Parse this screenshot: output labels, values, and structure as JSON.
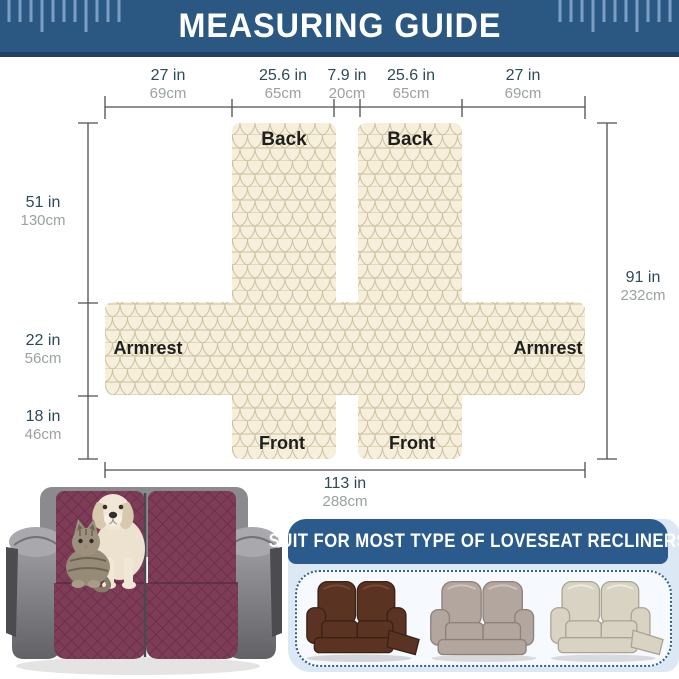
{
  "header": {
    "title": "MEASURING GUIDE"
  },
  "diagram": {
    "top_measurements": [
      {
        "in": "27 in",
        "cm": "69cm"
      },
      {
        "in": "25.6 in",
        "cm": "65cm"
      },
      {
        "in": "7.9 in",
        "cm": "20cm"
      },
      {
        "in": "25.6 in",
        "cm": "65cm"
      },
      {
        "in": "27 in",
        "cm": "69cm"
      }
    ],
    "left_measurements": [
      {
        "in": "51 in",
        "cm": "130cm"
      },
      {
        "in": "22 in",
        "cm": "56cm"
      },
      {
        "in": "18 in",
        "cm": "46cm"
      }
    ],
    "right_measurement": {
      "in": "91 in",
      "cm": "232cm"
    },
    "bottom_measurement": {
      "in": "113 in",
      "cm": "288cm"
    },
    "labels": {
      "back_left": "Back",
      "back_right": "Back",
      "armrest_left": "Armrest",
      "armrest_right": "Armrest",
      "front_left": "Front",
      "front_right": "Front"
    }
  },
  "suitability": {
    "title": "SUIT FOR MOST TYPE OF LOVESEAT RECLINERS",
    "recliner_styles": [
      "brown-leather-loveseat-recliner",
      "taupe-loveseat-recliner",
      "cream-loveseat-recliner"
    ]
  },
  "illustrations": {
    "photo": "burgundy-covered-loveseat-with-puppy-and-cat",
    "ruler_decorations": "ruler-tick-marks"
  },
  "colors": {
    "header_blue": "#2b5883",
    "header_strip": "#1d4265",
    "ruler_tick": "#7b9fc4",
    "fabric_cream": "#f6efdc",
    "fabric_line": "#cdc1a0",
    "measure_in_text": "#2e4a57",
    "measure_cm_text": "#9ba1a3",
    "panel_label_text": "#1e1e1c",
    "box_bar_blue": "#2b5a8c",
    "box_bg_blue": "#dce9f5",
    "cover_burgundy": "#7e3c56"
  }
}
